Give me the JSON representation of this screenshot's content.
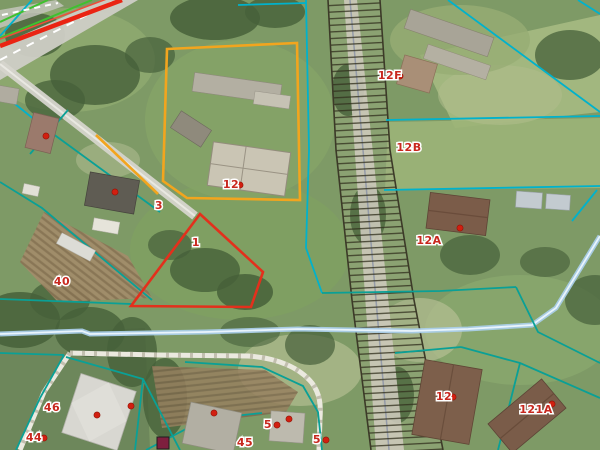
{
  "map": {
    "description": "Cadastral aerial map with parcel boundaries, highlighted parcels and plot number labels",
    "labels": [
      {
        "text": "12",
        "x": 231,
        "y": 188
      },
      {
        "text": "12F",
        "x": 390,
        "y": 79
      },
      {
        "text": "12B",
        "x": 409,
        "y": 151
      },
      {
        "text": "12A",
        "x": 429,
        "y": 244
      },
      {
        "text": "1",
        "x": 196,
        "y": 246
      },
      {
        "text": "3",
        "x": 159,
        "y": 209
      },
      {
        "text": "40",
        "x": 62,
        "y": 285
      },
      {
        "text": "46",
        "x": 52,
        "y": 411
      },
      {
        "text": "44",
        "x": 34,
        "y": 441
      },
      {
        "text": "5",
        "x": 268,
        "y": 428
      },
      {
        "text": "45",
        "x": 245,
        "y": 446
      },
      {
        "text": "5",
        "x": 317,
        "y": 443
      },
      {
        "text": "12",
        "x": 444,
        "y": 400
      },
      {
        "text": "121A",
        "x": 536,
        "y": 413
      }
    ],
    "address_points": [
      {
        "x": 46,
        "y": 136
      },
      {
        "x": 115,
        "y": 192
      },
      {
        "x": 240,
        "y": 185
      },
      {
        "x": 400,
        "y": 76
      },
      {
        "x": 460,
        "y": 228
      },
      {
        "x": 97,
        "y": 415
      },
      {
        "x": 44,
        "y": 438
      },
      {
        "x": 277,
        "y": 425
      },
      {
        "x": 326,
        "y": 440
      },
      {
        "x": 453,
        "y": 397
      },
      {
        "x": 552,
        "y": 404
      },
      {
        "x": 131,
        "y": 406
      },
      {
        "x": 214,
        "y": 413
      },
      {
        "x": 289,
        "y": 419
      }
    ],
    "special_markers": [
      {
        "shape": "square",
        "x": 163,
        "y": 443
      }
    ],
    "colors": {
      "label_red": "#c8281e",
      "address_point_red": "#d21f10",
      "parcel_line_cyan": "#00b2cc",
      "parcel_line_teal": "#0aa096",
      "highlight_orange": "#f2a51e",
      "highlight_red": "#e3301c",
      "red_utility_line": "#ea2413",
      "road_marking_green": "#3fc12e",
      "stream_blue": "#aacde8",
      "road_surface": "#cfcec6",
      "corridor_hatch": "#32301e",
      "path_white": "#ebe9df",
      "special_square": "#7e1f3e"
    }
  }
}
